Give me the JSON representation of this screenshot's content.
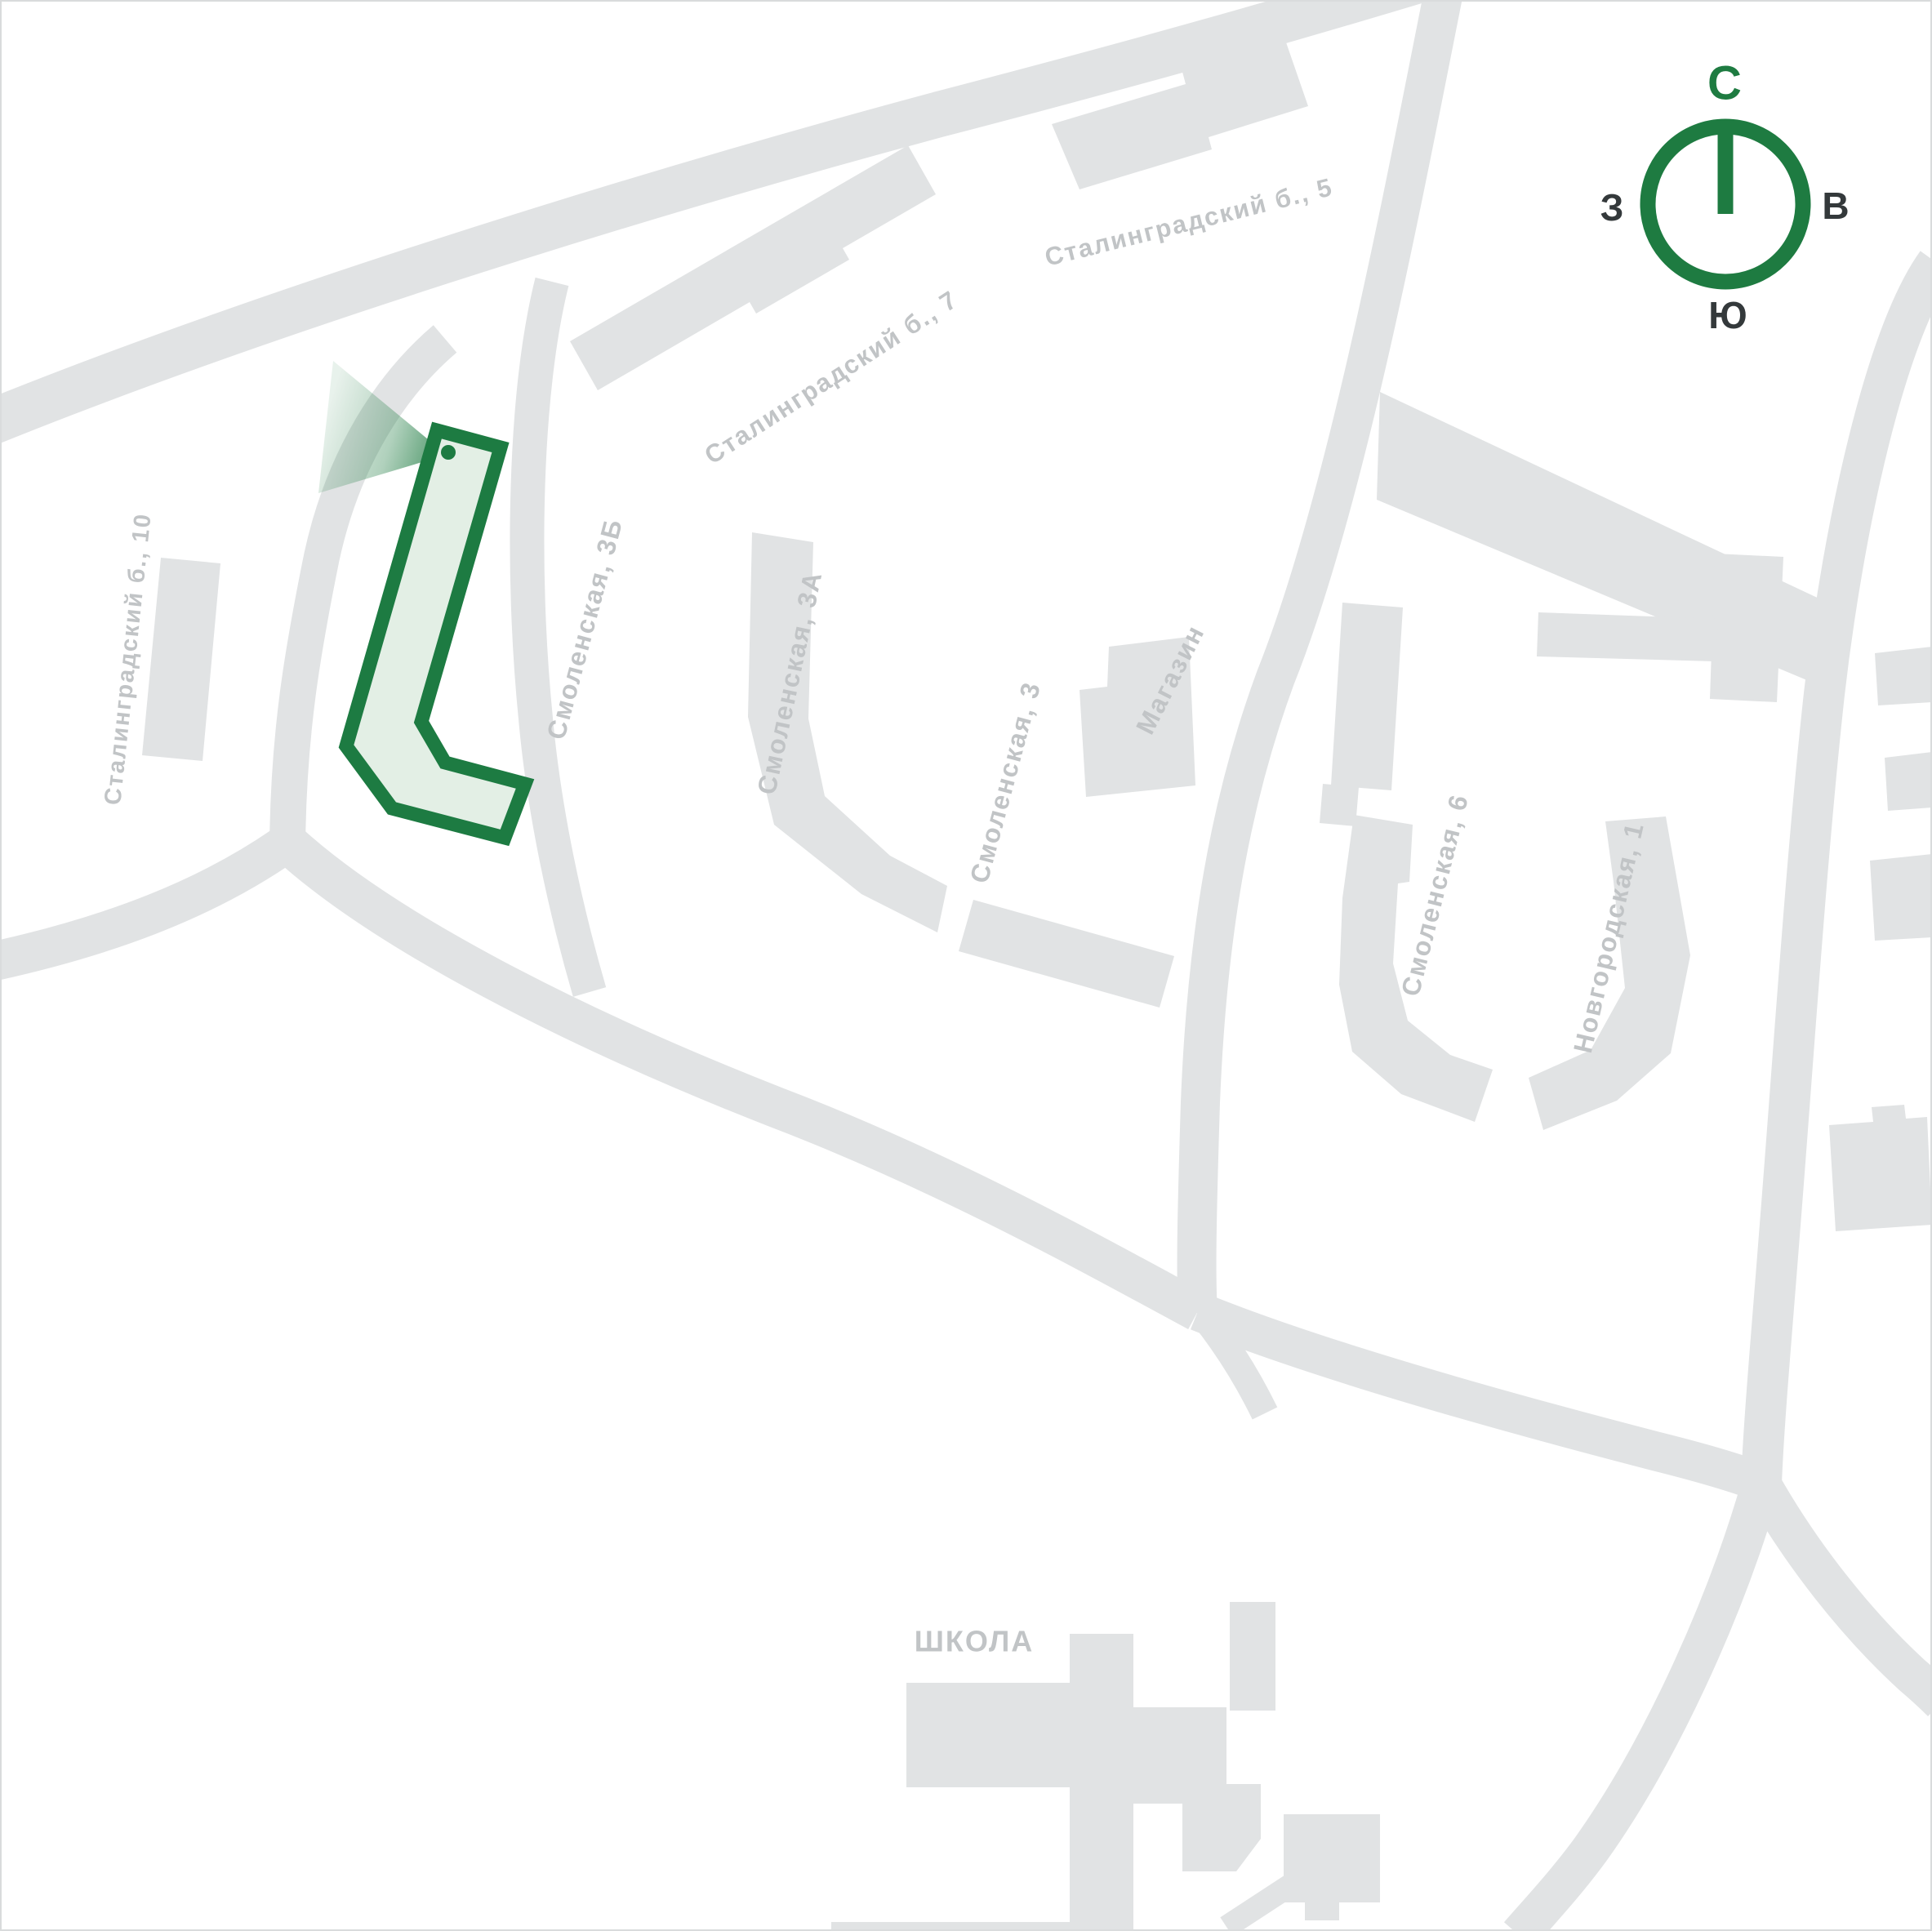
{
  "map_type": "residential-complex-location-map",
  "compass": {
    "north": "С",
    "east": "В",
    "south": "Ю",
    "west": "З"
  },
  "highlight": {
    "label": "Смоленская, 3Б",
    "outline_color": "#1d7b42",
    "fill_color": "#e3efe5"
  },
  "labels": {
    "stalingradsky_7": "Сталинградский б., 7",
    "stalingradsky_5": "Сталинградский б., 5",
    "stalingradsky_10": "Сталинградский б., 10",
    "smolenskaya_3b": "Смоленская, 3Б",
    "smolenskaya_3a": "Смоленская, 3А",
    "smolenskaya_3": "Смоленская, 3",
    "magazin": "Магазин",
    "smolenskaya_6": "Смоленская, 6",
    "novgorodskaya_1": "Новгородская, 1",
    "school": "ШКОЛА"
  },
  "colors": {
    "background": "#ffffff",
    "building_gray": "#e1e3e4",
    "road_gray": "#e1e3e4",
    "label_gray": "#c1c4c6",
    "accent_green": "#1e7b41",
    "compass_letter_dark": "#34393b"
  }
}
